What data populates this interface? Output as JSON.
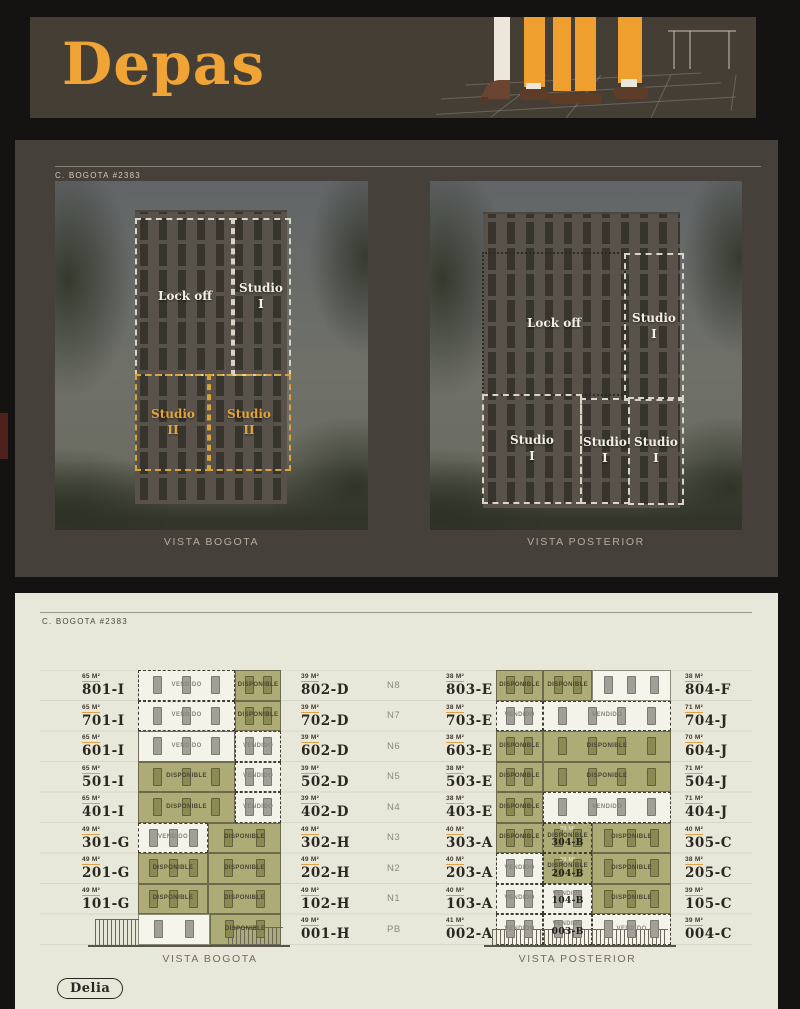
{
  "header": {
    "logo": "Depas"
  },
  "hero": {
    "address_label": "C. BOGOTA #2383",
    "left_photo": {
      "caption": "VISTA BOGOTA",
      "overlays": [
        {
          "label": "Lock off"
        },
        {
          "label": "Studio\nI"
        },
        {
          "label": "Studio\nII"
        },
        {
          "label": "Studio\nII"
        }
      ]
    },
    "right_photo": {
      "caption": "VISTA POSTERIOR",
      "overlays": [
        {
          "label": "Lock off"
        },
        {
          "label": "Studio\nI"
        },
        {
          "label": "Studio\nI"
        },
        {
          "label": "Studio\nI"
        },
        {
          "label": "Studio\nI"
        }
      ]
    }
  },
  "availability": {
    "address_label": "C. BOGOTA #2383",
    "status_labels": {
      "available": "DISPONIBLE",
      "sold": "VENDIDO"
    },
    "floors": [
      "N8",
      "N7",
      "N6",
      "N5",
      "N4",
      "N3",
      "N2",
      "N1",
      "PB"
    ],
    "left_elevation": {
      "caption": "VISTA BOGOTA",
      "rows": [
        {
          "floor": "N8",
          "left": {
            "area": "65 M²",
            "code": "801-I"
          },
          "right": {
            "area": "39 M²",
            "code": "802-D"
          },
          "units": [
            {
              "status": "VENDIDO",
              "style": "sold-dashed",
              "w": 68,
              "doors": 3
            },
            {
              "status": "DISPONIBLE",
              "style": "available",
              "w": 32,
              "doors": 2
            }
          ]
        },
        {
          "floor": "N7",
          "left": {
            "area": "65 M²",
            "code": "701-I"
          },
          "right": {
            "area": "39 M²",
            "code": "702-D"
          },
          "units": [
            {
              "status": "VENDIDO",
              "style": "sold-dashed",
              "w": 68,
              "doors": 3
            },
            {
              "status": "DISPONIBLE",
              "style": "available",
              "w": 32,
              "doors": 2
            }
          ]
        },
        {
          "floor": "N6",
          "left": {
            "area": "65 M²",
            "code": "601-I"
          },
          "right": {
            "area": "39 M²",
            "code": "602-D"
          },
          "units": [
            {
              "status": "VENDIDO",
              "style": "sold-solid",
              "w": 68,
              "doors": 3
            },
            {
              "status": "VENDIDO",
              "style": "sold-dashed",
              "w": 32,
              "doors": 2
            }
          ]
        },
        {
          "floor": "N5",
          "left": {
            "area": "65 M²",
            "code": "501-I"
          },
          "right": {
            "area": "39 M²",
            "code": "502-D"
          },
          "units": [
            {
              "status": "DISPONIBLE",
              "style": "available",
              "w": 68,
              "doors": 3
            },
            {
              "status": "VENDIDO",
              "style": "sold-dashed",
              "w": 32,
              "doors": 2
            }
          ]
        },
        {
          "floor": "N4",
          "left": {
            "area": "65 M²",
            "code": "401-I"
          },
          "right": {
            "area": "39 M²",
            "code": "402-D"
          },
          "units": [
            {
              "status": "DISPONIBLE",
              "style": "available",
              "w": 68,
              "doors": 3
            },
            {
              "status": "VENDIDO",
              "style": "sold-dashed",
              "w": 32,
              "doors": 2
            }
          ]
        },
        {
          "floor": "N3",
          "left": {
            "area": "49 M²",
            "code": "301-G"
          },
          "right": {
            "area": "49 M²",
            "code": "302-H"
          },
          "units": [
            {
              "status": "VENDIDO",
              "style": "sold-dashed",
              "w": 49,
              "doors": 3
            },
            {
              "status": "DISPONIBLE",
              "style": "available",
              "w": 51,
              "doors": 2
            }
          ]
        },
        {
          "floor": "N2",
          "left": {
            "area": "49 M²",
            "code": "201-G"
          },
          "right": {
            "area": "49 M²",
            "code": "202-H"
          },
          "units": [
            {
              "status": "DISPONIBLE",
              "style": "available",
              "w": 49,
              "doors": 3
            },
            {
              "status": "DISPONIBLE",
              "style": "available",
              "w": 51,
              "doors": 2
            }
          ]
        },
        {
          "floor": "N1",
          "left": {
            "area": "49 M²",
            "code": "101-G"
          },
          "right": {
            "area": "49 M²",
            "code": "102-H"
          },
          "units": [
            {
              "status": "DISPONIBLE",
              "style": "available",
              "w": 49,
              "doors": 3
            },
            {
              "status": "DISPONIBLE",
              "style": "available",
              "w": 51,
              "doors": 2
            }
          ]
        },
        {
          "floor": "PB",
          "left": null,
          "right": {
            "area": "49 M²",
            "code": "001-H"
          },
          "units": [
            {
              "status": "",
              "style": "facade",
              "w": 50,
              "doors": 2
            },
            {
              "status": "DISPONIBLE",
              "style": "available",
              "w": 50,
              "doors": 2
            }
          ]
        }
      ]
    },
    "right_elevation": {
      "caption": "VISTA POSTERIOR",
      "rows": [
        {
          "floor": "N8",
          "left": {
            "area": "38 M²",
            "code": "803-E"
          },
          "right": {
            "area": "38 M²",
            "code": "804-F"
          },
          "units": [
            {
              "status": "DISPONIBLE",
              "style": "available",
              "w": 27,
              "doors": 2
            },
            {
              "status": "DISPONIBLE",
              "style": "available",
              "w": 28,
              "doors": 2
            },
            {
              "status": "",
              "style": "plain",
              "w": 45,
              "doors": 3
            }
          ]
        },
        {
          "floor": "N7",
          "left": {
            "area": "38 M²",
            "code": "703-E"
          },
          "right": {
            "area": "71 M²",
            "code": "704-J"
          },
          "units": [
            {
              "status": "VENDIDO",
              "style": "sold-dashed",
              "w": 27,
              "doors": 2
            },
            {
              "status": "VENDIDO",
              "style": "sold-dashed",
              "w": 73,
              "doors": 4
            }
          ]
        },
        {
          "floor": "N6",
          "left": {
            "area": "38 M²",
            "code": "603-E"
          },
          "right": {
            "area": "70 M²",
            "code": "604-J"
          },
          "units": [
            {
              "status": "DISPONIBLE",
              "style": "available",
              "w": 27,
              "doors": 2
            },
            {
              "status": "DISPONIBLE",
              "style": "available",
              "w": 73,
              "doors": 4
            }
          ]
        },
        {
          "floor": "N5",
          "left": {
            "area": "38 M²",
            "code": "503-E"
          },
          "right": {
            "area": "71 M²",
            "code": "504-J"
          },
          "units": [
            {
              "status": "DISPONIBLE",
              "style": "available",
              "w": 27,
              "doors": 2
            },
            {
              "status": "DISPONIBLE",
              "style": "available",
              "w": 73,
              "doors": 4
            }
          ]
        },
        {
          "floor": "N4",
          "left": {
            "area": "38 M²",
            "code": "403-E"
          },
          "right": {
            "area": "71 M²",
            "code": "404-J"
          },
          "units": [
            {
              "status": "DISPONIBLE",
              "style": "available",
              "w": 27,
              "doors": 2
            },
            {
              "status": "VENDIDO",
              "style": "sold-dashed",
              "w": 73,
              "doors": 4
            }
          ]
        },
        {
          "floor": "N3",
          "left": {
            "area": "40 M²",
            "code": "303-A"
          },
          "right": {
            "area": "40 M²",
            "code": "305-C"
          },
          "units": [
            {
              "status": "DISPONIBLE",
              "style": "available",
              "w": 27,
              "doors": 2
            },
            {
              "area": "39 M²",
              "status": "DISPONIBLE",
              "code": "304-B",
              "style": "available-dashed",
              "w": 28,
              "doors": 2
            },
            {
              "status": "DISPONIBLE",
              "style": "available",
              "w": 45,
              "doors": 3
            }
          ]
        },
        {
          "floor": "N2",
          "left": {
            "area": "40 M²",
            "code": "203-A"
          },
          "right": {
            "area": "38 M²",
            "code": "205-C"
          },
          "units": [
            {
              "status": "VENDIDO",
              "style": "sold-dashed",
              "w": 27,
              "doors": 2
            },
            {
              "area": "39 M²",
              "status": "DISPONIBLE",
              "code": "204-B",
              "style": "available-dashed",
              "w": 28,
              "doors": 2
            },
            {
              "status": "DISPONIBLE",
              "style": "available",
              "w": 45,
              "doors": 3
            }
          ]
        },
        {
          "floor": "N1",
          "left": {
            "area": "40 M²",
            "code": "103-A"
          },
          "right": {
            "area": "39 M²",
            "code": "105-C"
          },
          "units": [
            {
              "status": "VENDIDO",
              "style": "sold-dashed",
              "w": 27,
              "doors": 2
            },
            {
              "status": "VENDIDO",
              "code": "104-B",
              "style": "sold-dashed",
              "w": 28,
              "doors": 2
            },
            {
              "status": "DISPONIBLE",
              "style": "available",
              "w": 45,
              "doors": 3
            }
          ]
        },
        {
          "floor": "PB",
          "left": {
            "area": "41 M²",
            "code": "002-A"
          },
          "right": {
            "area": "39 M²",
            "code": "004-C"
          },
          "units": [
            {
              "status": "VENDIDO",
              "style": "sold-dashed",
              "w": 27,
              "doors": 2
            },
            {
              "status": "VENDIDO",
              "code": "003-B",
              "style": "sold-dashed",
              "w": 28,
              "doors": 2
            },
            {
              "status": "VENDIDO",
              "style": "sold-dashed",
              "w": 45,
              "doors": 3
            }
          ]
        }
      ]
    }
  },
  "footer": {
    "logo": "Delia"
  },
  "colors": {
    "accent_orange": "#F0A435",
    "available_green": "#AEAC76",
    "sold_white": "#F4F3EA",
    "cream_panel": "#E8E8DA",
    "dark_panel": "#45403A",
    "page_bg": "#151311"
  }
}
